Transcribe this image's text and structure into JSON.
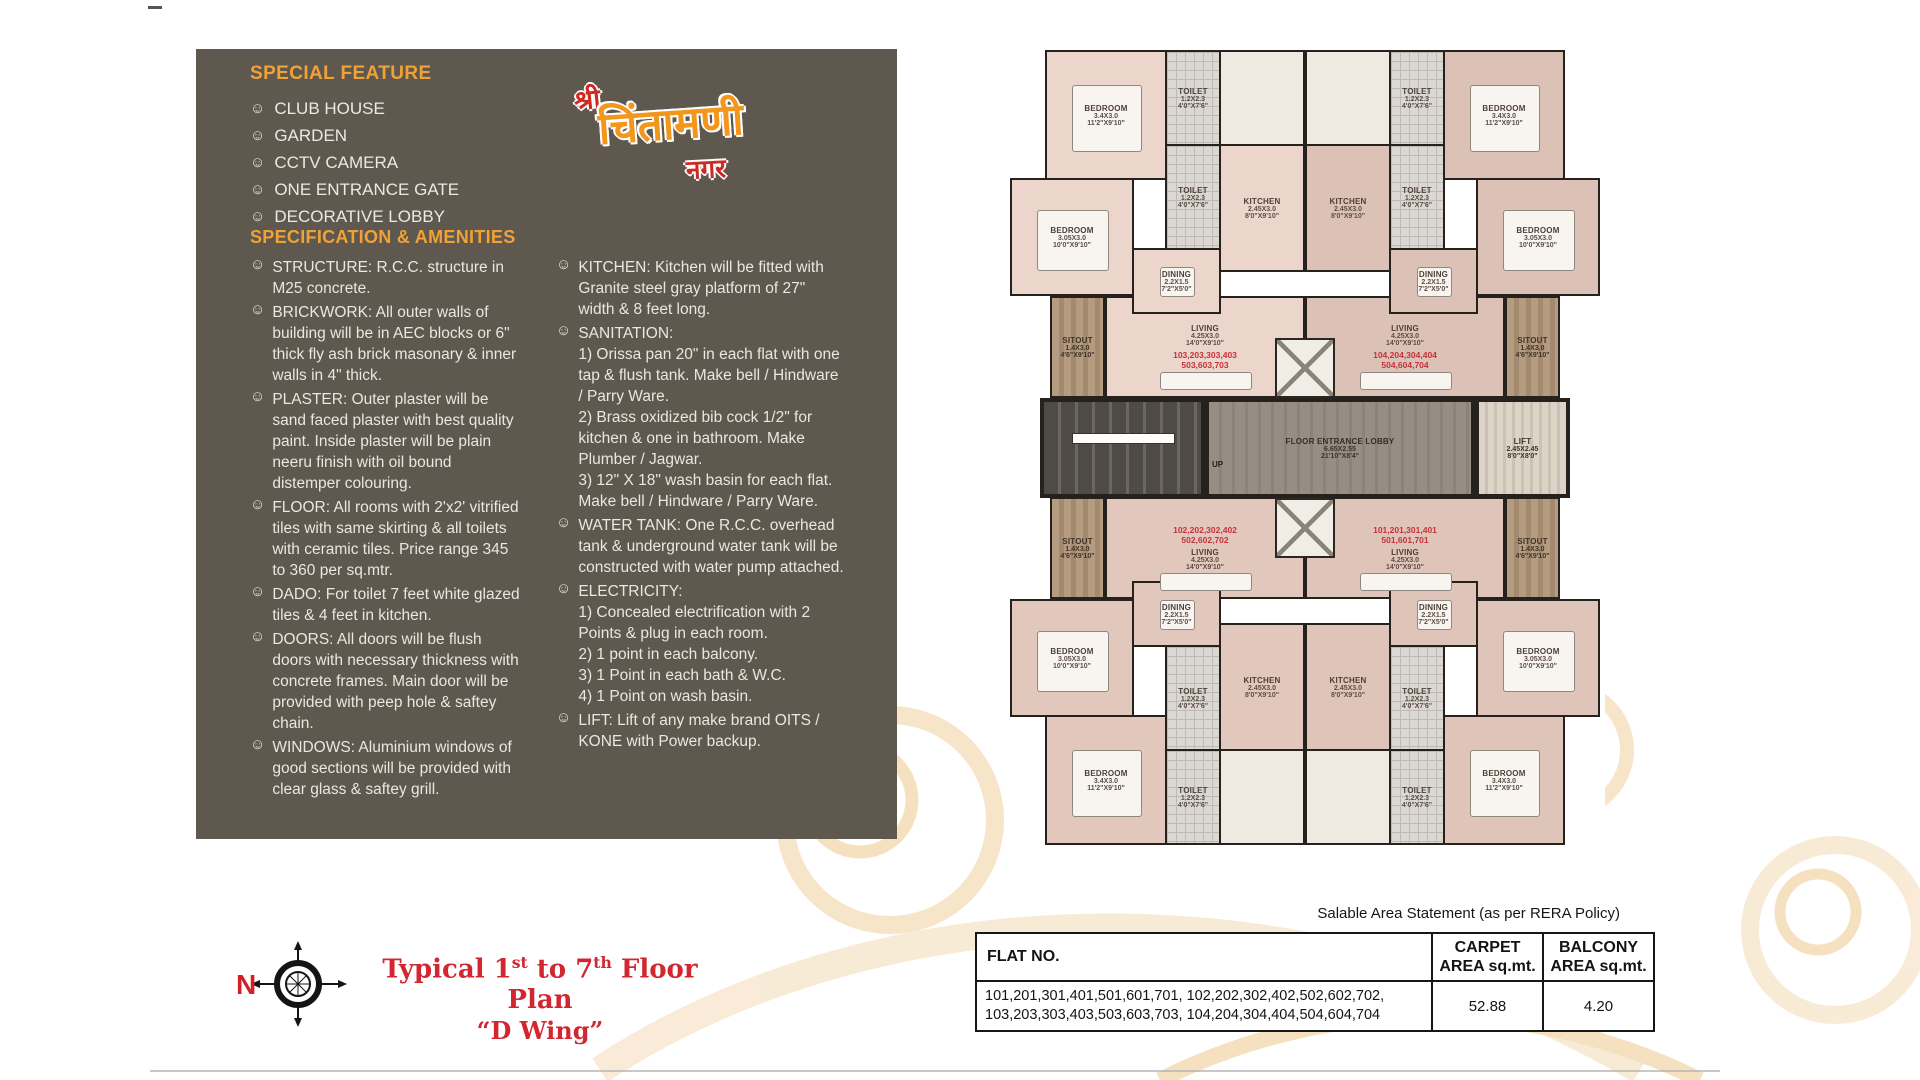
{
  "panel": {
    "bullet": "☺",
    "special_feature": {
      "heading": "SPECIAL FEATURE",
      "items": [
        "CLUB HOUSE",
        "GARDEN",
        "CCTV CAMERA",
        "ONE ENTRANCE GATE",
        "DECORATIVE LOBBY"
      ]
    },
    "spec": {
      "heading": "SPECIFICATION & AMENITIES",
      "col1": [
        "STRUCTURE: R.C.C. structure in M25 concrete.",
        "BRICKWORK: All outer walls of building will be in AEC blocks or 6\" thick fly ash brick masonary & inner walls in 4\" thick.",
        "PLASTER: Outer plaster will be sand faced plaster with best quality paint. Inside plaster will be plain neeru finish with oil bound distemper colouring.",
        "FLOOR: All rooms with 2'x2' vitrified tiles with same skirting & all toilets with ceramic tiles. Price range 345 to 360 per sq.mtr.",
        "DADO: For toilet 7 feet white glazed tiles & 4 feet in kitchen.",
        "DOORS: All doors will be flush doors with necessary thickness with concrete frames. Main door will be provided with peep hole & saftey chain.",
        "WINDOWS: Aluminium windows of good sections will be provided with clear glass & saftey grill."
      ],
      "col2": [
        "KITCHEN: Kitchen will be fitted with Granite steel gray platform of 27\" width & 8 feet long.",
        "SANITATION:\n1)  Orissa pan 20\" in each flat with one tap & flush tank. Make bell / Hindware / Parry Ware.\n2)  Brass oxidized bib cock 1/2\" for kitchen & one in bathroom. Make Plumber / Jagwar.\n3)  12\" X 18\" wash basin for each flat. Make bell / Hindware / Parry Ware.",
        "WATER TANK: One R.C.C. overhead tank & underground water tank will be constructed with water pump attached.",
        "ELECTRICITY:\n1)  Concealed electrification with 2 Points & plug in each room.\n2)  1 point in each balcony.\n3)  1 Point in each bath & W.C.\n4)  1 Point on wash basin.",
        "LIFT: Lift of any make brand OITS / KONE with Power backup."
      ]
    }
  },
  "logo": {
    "shri": "श्री",
    "name": "चिंतामणी",
    "nagar": "नगर"
  },
  "floor_title": {
    "p1": "Typical 1",
    "sup1": "st",
    "p2": " to 7",
    "sup2": "th",
    "p3": " Floor Plan",
    "line2": "“D Wing”",
    "north": "N"
  },
  "plan": {
    "rooms": {
      "bedroom_large": {
        "name": "BEDROOM",
        "dim_m": "3.4X3.0",
        "dim_ft": "11'2\"X9'10\""
      },
      "bedroom_small": {
        "name": "BEDROOM",
        "dim_m": "3.05X3.0",
        "dim_ft": "10'0\"X9'10\""
      },
      "toilet": {
        "name": "TOILET",
        "dim_m": "1.2X2.3",
        "dim_ft": "4'0\"X7'6\""
      },
      "kitchen": {
        "name": "KITCHEN",
        "dim_m": "2.45X3.0",
        "dim_ft": "8'0\"X9'10\""
      },
      "dining": {
        "name": "DINING",
        "dim_m": "2.2X1.5",
        "dim_ft": "7'2\"X5'0\""
      },
      "living": {
        "name": "LIVING",
        "dim_m": "4.25X3.0",
        "dim_ft": "14'0\"X9'10\""
      },
      "sitout": {
        "name": "SITOUT",
        "dim_m": "1.4X3.0",
        "dim_ft": "4'6\"X9'10\""
      }
    },
    "lobby": {
      "name": "FLOOR ENTRANCE LOBBY",
      "dim_m": "6.65X2.55",
      "dim_ft": "21'10\"X8'4\""
    },
    "lift": {
      "name": "LIFT",
      "dim_m": "2.45X2.45",
      "dim_ft": "8'0\"X8'0\""
    },
    "up": "UP",
    "flat_numbers": {
      "top_left": "103,203,303,403\n503,603,703",
      "top_right": "104,204,304,404\n504,604,704",
      "bottom_left": "102,202,302,402\n502,602,702",
      "bottom_right": "101,201,301,401\n501,601,701"
    }
  },
  "table": {
    "caption": "Salable Area Statement (as per RERA Policy)",
    "col_flat": "FLAT NO.",
    "col_carpet": "CARPET\nAREA sq.mt.",
    "col_balcony": "BALCONY\nAREA sq.mt.",
    "row_flats": "101,201,301,401,501,601,701, 102,202,302,402,502,602,702,\n103,203,303,403,503,603,703, 104,204,304,404,504,604,704",
    "row_carpet": "52.88",
    "row_balcony": "4.20"
  }
}
